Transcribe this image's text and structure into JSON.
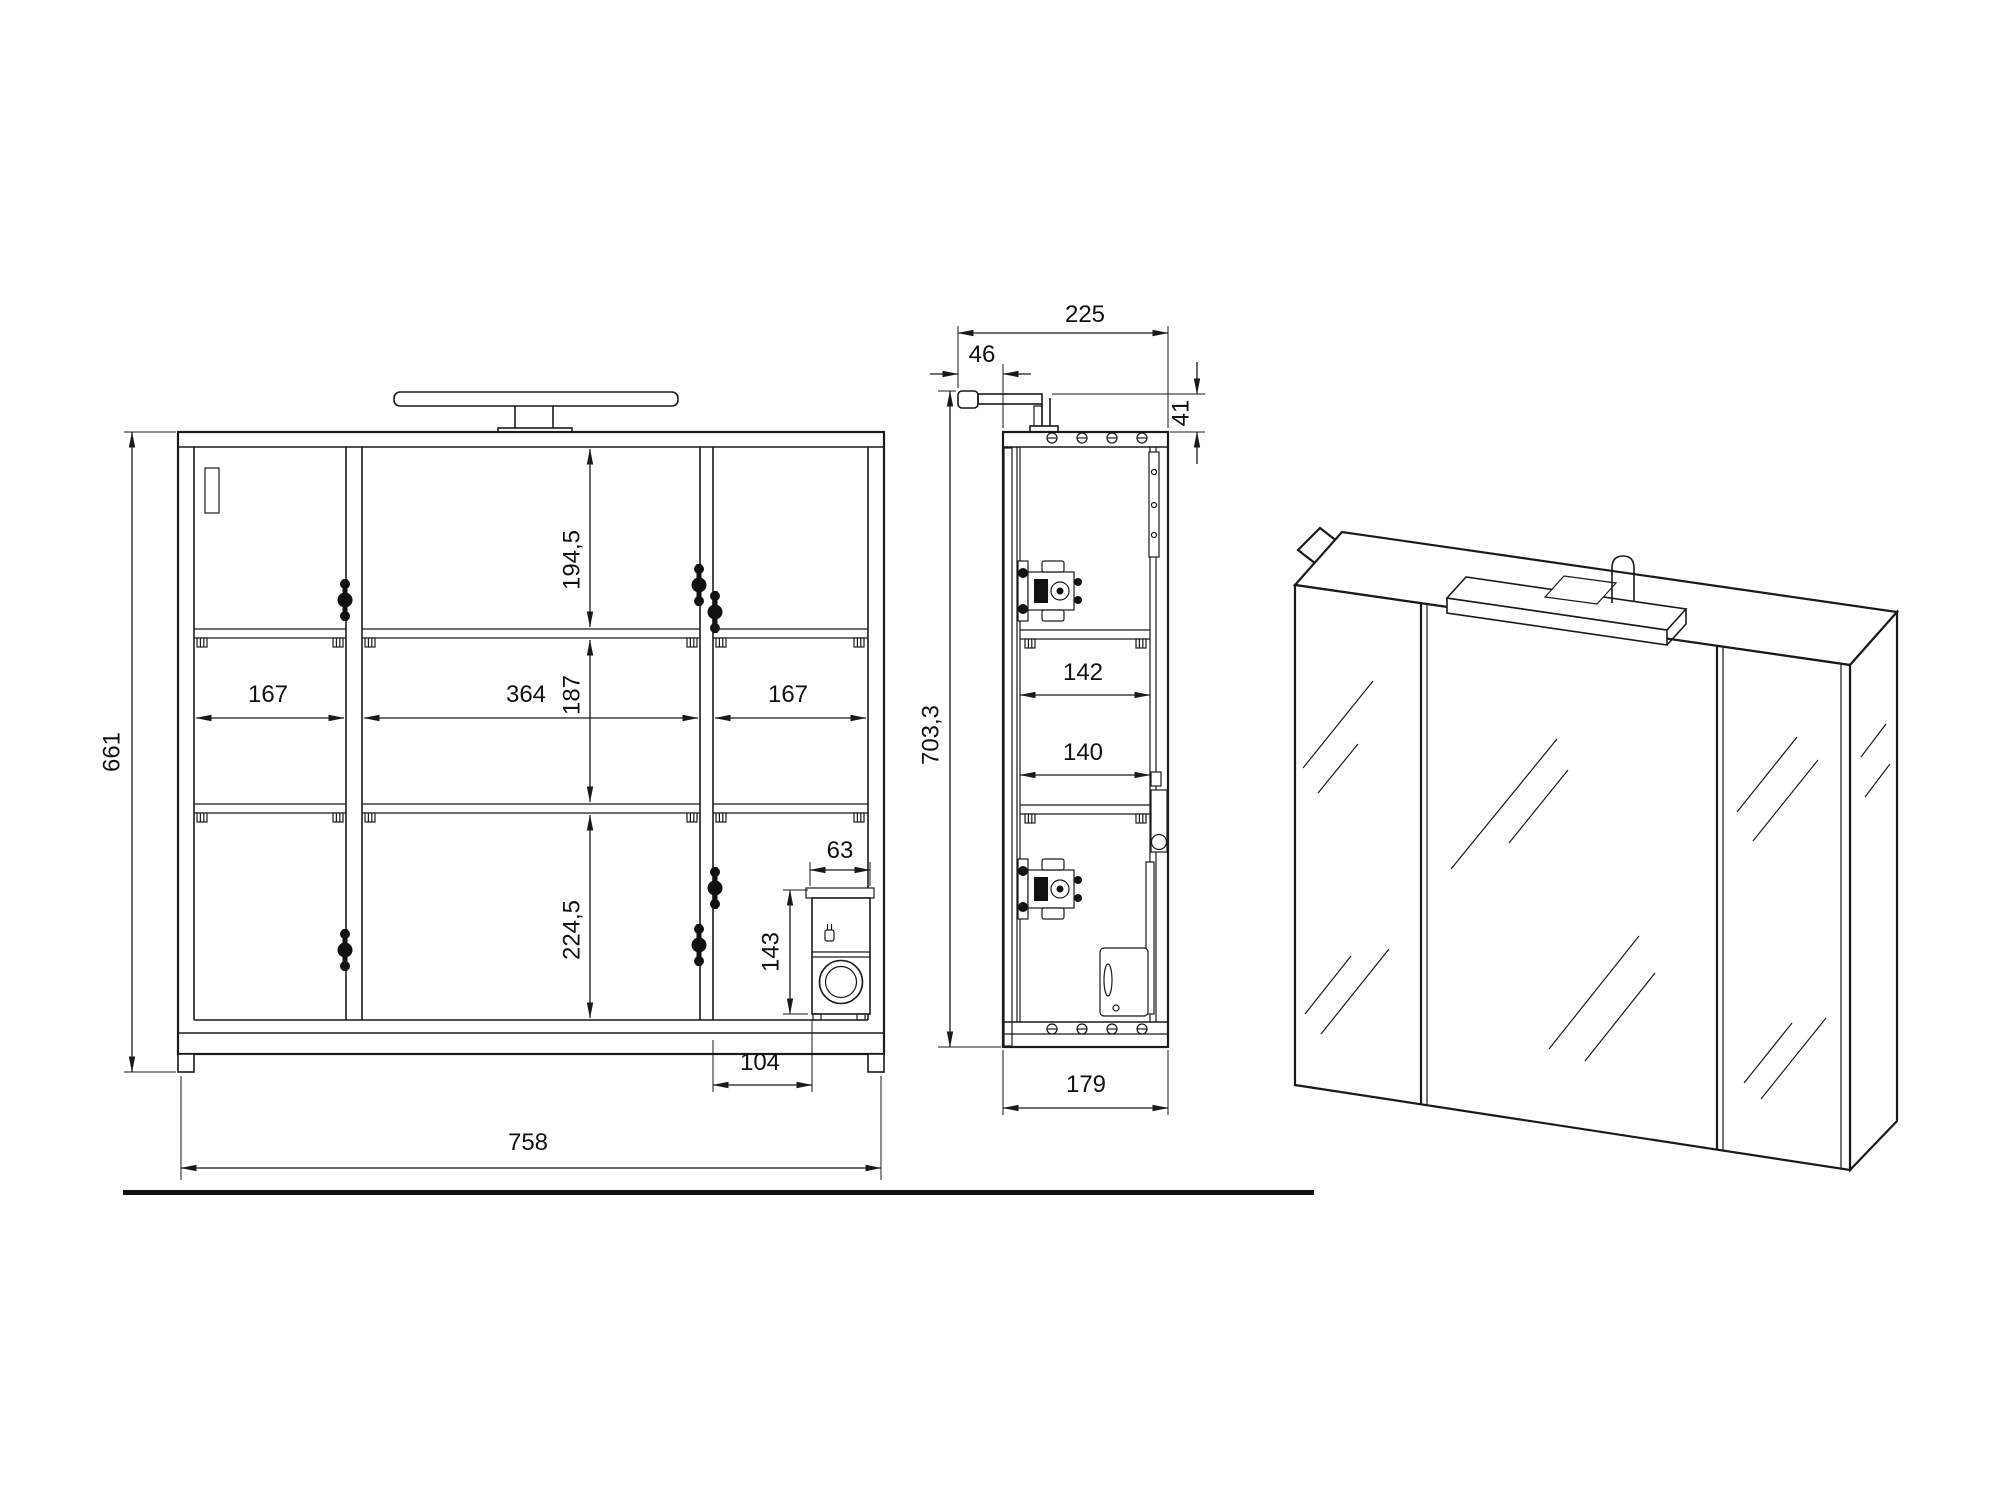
{
  "colors": {
    "line": "#1a1a1a",
    "background": "#ffffff"
  },
  "drawing": {
    "front": {
      "dims": {
        "overall_height": "661",
        "overall_width": "758",
        "top_section": "194,5",
        "middle_section": "187",
        "bottom_section": "224,5",
        "left_compartment": "167",
        "center_compartment": "364",
        "right_compartment": "167",
        "socket_width": "63",
        "socket_height": "143",
        "socket_offset": "104"
      }
    },
    "side": {
      "dims": {
        "total_depth": "225",
        "light_overhang": "46",
        "light_height": "41",
        "total_height": "703,3",
        "upper_shelf_depth": "142",
        "lower_shelf_depth": "140",
        "body_depth": "179"
      }
    }
  }
}
